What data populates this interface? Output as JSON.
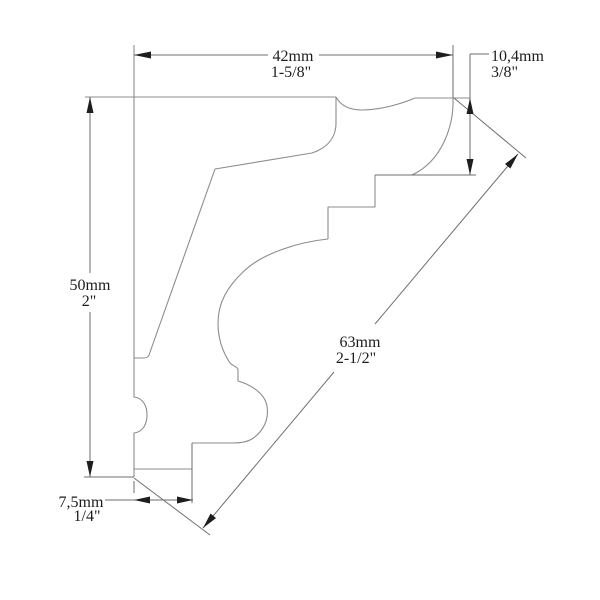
{
  "drawing": {
    "title": "crown molding cross-section profile drawing",
    "dimensions": {
      "top_width": {
        "metric": "42mm",
        "imperial": "1-5/8\""
      },
      "top_right_drop": {
        "metric": "10,4mm",
        "imperial": "3/8\""
      },
      "left_height": {
        "metric": "50mm",
        "imperial": "2\""
      },
      "diagonal_face": {
        "metric": "63mm",
        "imperial": "2-1/2\""
      },
      "bottom_width": {
        "metric": "7,5mm",
        "imperial": "1/4\""
      }
    }
  },
  "colors": {
    "background": "#ffffff",
    "profile_line": "#8c8c8c",
    "dimension_line": "#6e6e6e",
    "arrowhead": "#1e1e1e",
    "label_text": "#1c1c1c"
  }
}
